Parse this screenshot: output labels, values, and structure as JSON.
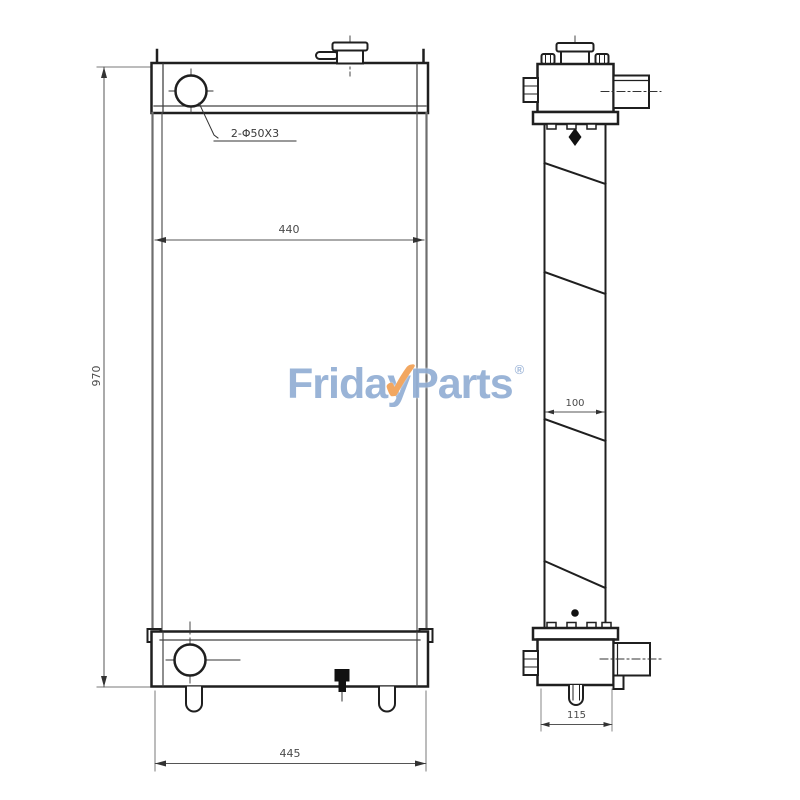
{
  "drawing": {
    "title": "radiator-technical-drawing",
    "port_label": "2-Φ50X3",
    "dims": {
      "core_width": "440",
      "overall_height": "970",
      "overall_width": "445",
      "core_depth": "100",
      "tank_depth": "115"
    },
    "colors": {
      "line": "#1f1f1f",
      "gray_line": "#6e6e6e",
      "dim_line": "#555555"
    }
  },
  "watermark": {
    "part1": "Frida",
    "letter_y": "y",
    "check": "✓",
    "part2": "Parts",
    "registered": "®",
    "blue": "#93afd5",
    "orange": "#f2a156"
  }
}
